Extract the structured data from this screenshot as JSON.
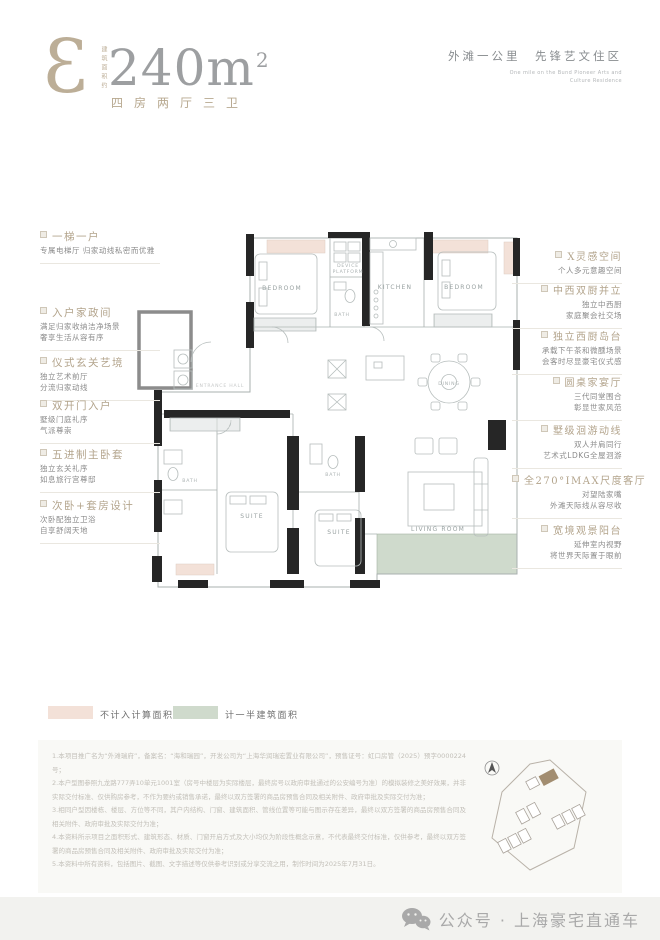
{
  "header": {
    "monogram": "3",
    "area_label_vertical": "建筑面积约",
    "area_value": "240m",
    "area_sup": "2",
    "rooms_line": "四房两厅三卫",
    "tagline": "外滩一公里　先锋艺文住区",
    "tagline_en1": "One mile on the Bund Pioneer Arts and",
    "tagline_en2": "Culture Residence"
  },
  "plan": {
    "rooms": {
      "bedroom_tl": "BEDROOM",
      "bath_top": "BATH",
      "device_line1": "DEVICE",
      "device_line2": "PLATFORM",
      "kitchen": "KITCHEN",
      "bedroom_tr": "BEDROOM",
      "entrance": "ENTRANCE HALL",
      "dining": "DINING",
      "bath_left": "BATH",
      "suite1": "SUITE",
      "bath_mid": "BATH",
      "suite2": "SUITE",
      "living": "LIVING ROOM"
    }
  },
  "left_annotations": [
    {
      "title": "一梯一户",
      "lines": [
        "专属电梯厅 归家动线私密而优雅"
      ]
    },
    {
      "title": "入户家政间",
      "lines": [
        "满足归家收纳洁净场景",
        "奢享生活从容有序"
      ]
    },
    {
      "title": "仪式玄关艺境",
      "lines": [
        "独立艺术前厅",
        "分流归家动线"
      ]
    },
    {
      "title": "双开门入户",
      "lines": [
        "墅级门庭礼序",
        "气派尊崇"
      ]
    },
    {
      "title": "五进制主卧套",
      "lines": [
        "独立玄关礼序",
        "如息旅行宫尊邸"
      ]
    },
    {
      "title": "次卧+套房设计",
      "lines": [
        "次卧配独立卫浴",
        "自享舒阔天地"
      ]
    }
  ],
  "right_annotations": [
    {
      "title": "X灵感空间",
      "lines": [
        "个人多元意趣空间"
      ]
    },
    {
      "title": "中西双厨并立",
      "lines": [
        "独立中西厨",
        "家庭聚会社交场"
      ]
    },
    {
      "title": "独立西厨岛台",
      "lines": [
        "承载下午茶和微醺场景",
        "会客时尽显豪宅仪式感"
      ]
    },
    {
      "title": "圆桌家宴厅",
      "lines": [
        "三代同堂围合",
        "彰显世家风范"
      ]
    },
    {
      "title": "墅级洄游动线",
      "lines": [
        "双人并肩同行",
        "艺术式LDKG全屋洄游"
      ]
    },
    {
      "title": "全270°IMAX尺度客厅",
      "lines": [
        "对望陆家嘴",
        "外滩天际线从容尽收"
      ]
    },
    {
      "title": "宽境观景阳台",
      "lines": [
        "延伸室内视野",
        "将世界天际置于眼前"
      ]
    }
  ],
  "legend": [
    {
      "color": "#f3e1d8",
      "label": "不计入计算面积"
    },
    {
      "color": "#cfdacc",
      "label": "计一半建筑面积"
    }
  ],
  "disclaimer": [
    "1.本项目推广名为“外滩瑞府”，备案名：“海和瑞园”，开发公司为“上海华润瑞宏置业有限公司”，预售证号：虹口房管（2025）预字0000224号；",
    "2.本户型图参照九龙路777弄10单元1001室（房号中楼层为实际楼层，最终房号以政府审批通过的公安编号为准）的模拟装修之美好效果，并非实际交付标准、仅供购房参考，不作为要约或销售承诺，最终以双方签署的商品房预售合同及相关附件、政府审批及实际交付为准；",
    "3.相同户型因楼栋、楼层、方位等不同，其户内结构、门窗、建筑面积、管线位置等可能与图示存在差异，最终以双方签署的商品房预售合同及相关附件、政府审批及实际交付为准；",
    "4.本资料所示项目之面积形式、建筑形态、材质、门窗开启方式及大小均仅为阶段性概念示意，不代表最终交付标准，仅供参考，最终以双方签署的商品房预售合同及相关附件、政府审批及实际交付为准；",
    "5.本资料中所有资料，包括图片、截图、文字描述等仅供参考识别或分享交流之用，制作时间为2025年7月31日。"
  ],
  "footer": {
    "wechat_label": "公众号 · 上海豪宅直通车"
  },
  "colors": {
    "accent_taupe": "#b3a48c",
    "bay_pink": "#f3e1d8",
    "balcony_green": "#cfdacc",
    "wall_black": "#262626"
  }
}
